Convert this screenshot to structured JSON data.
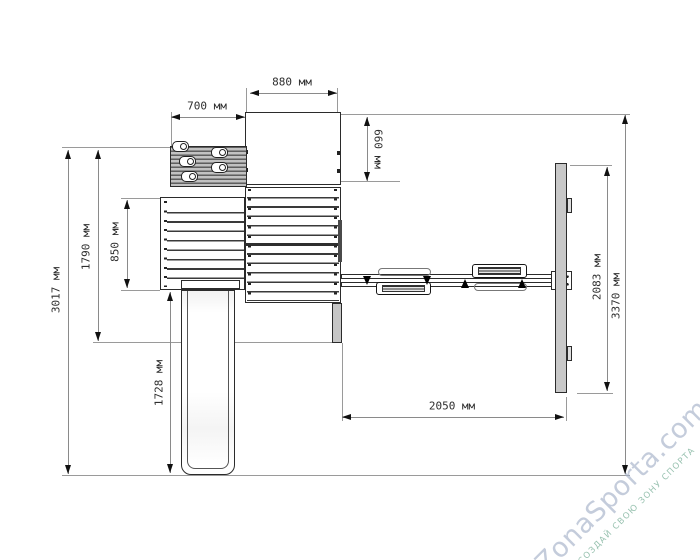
{
  "unit": "мм",
  "dims": {
    "tower_width": "880 мм",
    "climb_wall_width": "700 мм",
    "tower_depth": "660 мм",
    "overall_depth": "3017 мм",
    "frame_depth": "1790 мм",
    "deck_width": "850 мм",
    "slide_length": "1728 мм",
    "swing_beam_span": "2050 мм",
    "aframe_base_length": "2083 мм",
    "overall_width": "3370 мм"
  },
  "watermark": {
    "brand": "ZonaSporta.com",
    "slogan": "СОЗДАЙ СВОЮ ЗОНУ СПОРТА"
  },
  "colors": {
    "outline": "#2b2b2b",
    "dimension_line": "#8a8a8a",
    "arrow": "#111111",
    "post_fill": "#c8c8c8",
    "watermark_brand": "#a4b1c7",
    "watermark_slogan": "#7db29b"
  }
}
